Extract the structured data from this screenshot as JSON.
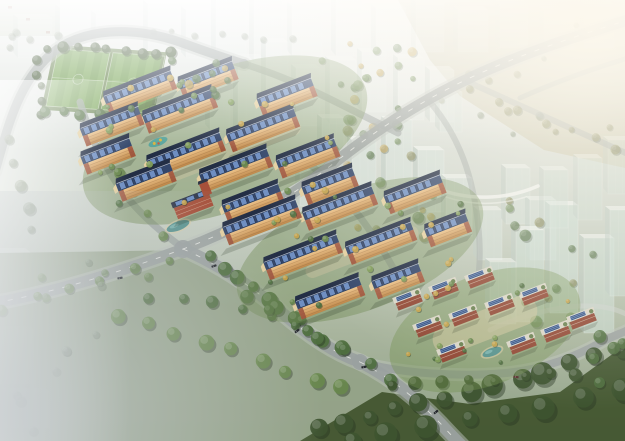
{
  "image": {
    "description": "aerial-render-residential-masterplan",
    "width": 625,
    "height": 441
  },
  "palette": {
    "road": "#9aa19f",
    "roadShoulder": "#bcc1bc",
    "roadLight": "#cdd2cd",
    "white": "#f2f4f1",
    "treeColors": [
      "#3e5430",
      "#507040",
      "#68884c",
      "#7f9c58",
      "#c4a24b",
      "#8a8a55",
      "#84937a"
    ],
    "treeShadow": "#263420",
    "glassTints": [
      "#e9efec",
      "#d4e1db",
      "#cadcd3"
    ],
    "glassSide": "#b9c8c1",
    "glassTop": "#f2f6f3",
    "panelBlue": "#6e8ec2",
    "panelEdge": "#1f2a40",
    "roofFront": "#33466b",
    "roofBack": "#232e45",
    "ridge": "#cfd8e6",
    "facadeTop": "#ecc289",
    "facadeBottom": "#bc8547",
    "brick": "#9a4f3b",
    "gableCream": "#e3cfa0",
    "townWall": "#914835",
    "townRoof": "#d9d5c6",
    "clubhouseWall": "#a6503a",
    "clubhouseRoof": "#333a4c",
    "water": "#4f8f8d",
    "sand": "#d8cba6",
    "fieldBase": "#6d9a4d",
    "fieldStripe": "#78a556",
    "fieldApron": "#5d7a42",
    "meadow": "#93a287",
    "darkTrees": "#42552f",
    "topRightMeadow": "#c8c5ac",
    "shadow": "#26321f",
    "car": "#23262b",
    "carRed": "#5a3330",
    "mist": "#c6cbd1",
    "redSpeck": "#8a4434"
  },
  "scene": {
    "whiteCity": [
      [
        18,
        18,
        34,
        40,
        0.22
      ],
      [
        60,
        8,
        28,
        46,
        0.25
      ],
      [
        96,
        14,
        40,
        44,
        0.22
      ],
      [
        148,
        4,
        30,
        52,
        0.28
      ],
      [
        186,
        10,
        26,
        48,
        0.3
      ],
      [
        216,
        0,
        30,
        54,
        0.3
      ],
      [
        254,
        0,
        28,
        62,
        0.32
      ],
      [
        292,
        6,
        30,
        50,
        0.3
      ],
      [
        336,
        0,
        26,
        56,
        0.3
      ],
      [
        376,
        8,
        30,
        48,
        0.28
      ],
      [
        416,
        2,
        28,
        50,
        0.26
      ],
      [
        458,
        10,
        30,
        42,
        0.24
      ],
      [
        500,
        4,
        28,
        44,
        0.22
      ],
      [
        544,
        10,
        30,
        40,
        0.2
      ],
      [
        584,
        4,
        30,
        44,
        0.18
      ]
    ],
    "topGhosts": [
      [
        238,
        58,
        26,
        78,
        0.4
      ],
      [
        266,
        42,
        22,
        66,
        0.42
      ],
      [
        296,
        68,
        24,
        58,
        0.4
      ],
      [
        330,
        60,
        26,
        64,
        0.38
      ],
      [
        362,
        52,
        24,
        60,
        0.35
      ],
      [
        398,
        58,
        26,
        62,
        0.38
      ],
      [
        430,
        70,
        24,
        52,
        0.4
      ],
      [
        210,
        80,
        20,
        50,
        0.35
      ]
    ],
    "midTowers": [
      [
        322,
        118,
        22,
        52,
        0.55
      ],
      [
        352,
        140,
        24,
        58,
        0.6
      ],
      [
        386,
        120,
        26,
        66,
        0.6
      ],
      [
        418,
        150,
        26,
        62,
        0.65
      ],
      [
        300,
        160,
        22,
        46,
        0.5
      ],
      [
        446,
        178,
        26,
        58,
        0.6
      ],
      [
        478,
        210,
        24,
        50,
        0.55
      ],
      [
        506,
        168,
        24,
        56,
        0.5
      ],
      [
        440,
        92,
        22,
        40,
        0.45
      ],
      [
        530,
        200,
        26,
        60,
        0.5
      ]
    ],
    "farTowers": [
      [
        516,
        230,
        28,
        92,
        0.62
      ],
      [
        550,
        205,
        28,
        108,
        0.65
      ],
      [
        584,
        238,
        30,
        95,
        0.6
      ],
      [
        610,
        210,
        26,
        86,
        0.55
      ],
      [
        544,
        170,
        24,
        58,
        0.4
      ],
      [
        578,
        158,
        24,
        62,
        0.4
      ],
      [
        608,
        140,
        22,
        54,
        0.35
      ],
      [
        490,
        262,
        26,
        62,
        0.55
      ]
    ],
    "leftGhosts": [
      [
        0,
        330,
        34,
        54,
        0.3
      ],
      [
        6,
        392,
        44,
        36,
        0.25
      ],
      [
        0,
        252,
        30,
        40,
        0.22
      ]
    ],
    "redSpecks": [
      [
        8,
        6
      ],
      [
        26,
        18
      ],
      [
        46,
        31
      ]
    ],
    "trMeadowPoly": "398,0 625,0 625,168 544,150 460,96 430,60",
    "meadowPoly": "0,253 190,250 252,286 332,342 424,402 392,441 0,441",
    "darkBandPoly": "300,441 382,392 470,404 560,392 625,345 625,441",
    "field": {
      "matrix": [
        1,
        0.067,
        -0.21,
        1,
        58,
        49
      ],
      "w": 104,
      "h": 57,
      "split": 52
    },
    "roads": [
      [
        "M -5,172 C 8,126 18,84 50,55 C 80,28 134,24 188,45 C 210,53 228,59 244,64",
        9,
        "road",
        0.85,
        "s"
      ],
      [
        "M 244,64 C 280,75 308,88 340,104 C 362,115 380,124 398,133",
        7,
        "road",
        0.7,
        ""
      ],
      [
        "M -6,303 C 56,292 120,272 183,249 C 246,226 292,196 334,163 C 376,130 424,99 474,76 C 522,54 570,38 628,20",
        11,
        "road",
        0.9,
        "sd"
      ],
      [
        "M 183,248 C 152,226 128,202 112,176 C 97,152 88,128 80,102",
        7,
        "road",
        0.75,
        ""
      ],
      [
        "M 183,249 C 218,264 250,285 280,311 C 306,334 332,352 360,362",
        12,
        "road",
        0.92,
        "sd"
      ],
      [
        "M 360,362 C 402,374 462,377 506,373 C 546,369 576,356 600,343 C 612,336 620,334 628,330",
        8,
        "road",
        0.9,
        "s"
      ],
      [
        "M 360,362 C 388,376 416,398 440,423 C 450,434 456,440 462,446",
        12,
        "road",
        0.92,
        "sd"
      ],
      [
        "M 306,161 C 330,181 352,205 368,228 C 384,251 398,274 407,297",
        7,
        "road",
        0.72,
        ""
      ],
      [
        "M 430,102 C 452,128 466,158 473,192 C 479,222 481,248 479,270",
        6,
        "road",
        0.5,
        ""
      ],
      [
        "M 468,82 L 628,154",
        6,
        "road",
        0.5,
        ""
      ],
      [
        "M 520,98 C 558,81 592,69 628,58",
        5,
        "road",
        0.45,
        ""
      ],
      [
        "M 490,330 C 520,316 550,308 580,306 C 600,305 614,308 626,314",
        5,
        "light",
        0.5,
        ""
      ],
      [
        "M 436,188 C 468,201 506,200 538,186",
        3.5,
        "white",
        0.8,
        ""
      ],
      [
        "M 446,197 C 472,206 500,205 526,197",
        1.6,
        "white",
        0.55,
        ""
      ]
    ],
    "junctions": [
      [
        183,
        249,
        9
      ],
      [
        360,
        362,
        8
      ],
      [
        244,
        64,
        5
      ]
    ],
    "lawns": [
      [
        225,
        140,
        150,
        70,
        "#6c884e",
        0.45
      ],
      [
        360,
        250,
        130,
        60,
        "#6c884e",
        0.4
      ],
      [
        485,
        330,
        100,
        55,
        "#74904f",
        0.4
      ]
    ],
    "plazas": [
      [
        235,
        150,
        140,
        16,
        "#cfc3a0",
        0.45
      ],
      [
        362,
        252,
        120,
        14,
        "#cfc3a0",
        0.4
      ],
      [
        485,
        325,
        110,
        30,
        "#d6c9a2",
        0.5
      ]
    ],
    "slabs": [
      [
        140,
        92,
        72
      ],
      [
        208,
        80,
        58
      ],
      [
        287,
        97,
        58
      ],
      [
        112,
        126,
        62
      ],
      [
        180,
        111,
        74
      ],
      [
        263,
        130,
        72
      ],
      [
        108,
        156,
        52
      ],
      [
        186,
        155,
        78
      ],
      [
        308,
        158,
        62
      ],
      [
        146,
        182,
        58
      ],
      [
        236,
        170,
        72
      ],
      [
        330,
        186,
        54
      ],
      [
        253,
        203,
        60
      ],
      [
        262,
        222,
        78
      ],
      [
        340,
        208,
        74
      ],
      [
        415,
        194,
        60
      ],
      [
        448,
        230,
        44
      ],
      [
        303,
        257,
        78
      ],
      [
        381,
        243,
        70
      ],
      [
        330,
        298,
        68
      ],
      [
        398,
        281,
        50
      ]
    ],
    "townhouses": [
      [
        408,
        299
      ],
      [
        444,
        288
      ],
      [
        480,
        277
      ],
      [
        428,
        326
      ],
      [
        464,
        315
      ],
      [
        500,
        304
      ],
      [
        534,
        294
      ],
      [
        452,
        351
      ],
      [
        522,
        343
      ],
      [
        556,
        331
      ],
      [
        582,
        318
      ]
    ],
    "clubhouse": [
      193,
      205
    ],
    "ponds": [
      [
        96,
        157,
        8,
        3
      ],
      [
        178,
        226,
        12,
        4.5
      ],
      [
        492,
        352,
        10,
        4
      ]
    ],
    "playground": [
      158,
      142
    ],
    "treeRows": [
      [
        46,
        47,
        170,
        54,
        9,
        5,
        0,
        0.95
      ],
      [
        34,
        60,
        42,
        112,
        5,
        4.5,
        0,
        0.9
      ],
      [
        44,
        112,
        156,
        119,
        7,
        4.5,
        1,
        0.95
      ],
      [
        168,
        62,
        156,
        110,
        4,
        4,
        1,
        0.85
      ],
      [
        208,
        258,
        338,
        348,
        10,
        7,
        1,
        0.95
      ],
      [
        122,
        314,
        342,
        388,
        9,
        6.5,
        2,
        0.9
      ],
      [
        152,
        296,
        300,
        318,
        6,
        5.5,
        1,
        0.85
      ],
      [
        318,
        430,
        622,
        352,
        13,
        9,
        0,
        0.95
      ],
      [
        350,
        441,
        625,
        392,
        8,
        10,
        0,
        0.9
      ],
      [
        248,
        296,
        392,
        378,
        7,
        6,
        1,
        0.9
      ],
      [
        392,
        388,
        576,
        372,
        8,
        5.5,
        0,
        0.9
      ],
      [
        12,
        142,
        30,
        232,
        5,
        5,
        6,
        0.6
      ],
      [
        472,
        92,
        618,
        150,
        7,
        4,
        5,
        0.55
      ],
      [
        152,
        30,
        290,
        40,
        7,
        3,
        6,
        0.45
      ],
      [
        92,
        130,
        160,
        235,
        6,
        4.5,
        2,
        0.8
      ],
      [
        2,
        308,
        170,
        262,
        6,
        5,
        2,
        0.75
      ]
    ],
    "treeRegions": [
      [
        298,
        42,
        135,
        68,
        16,
        2.5,
        5,
        [
          1,
          2,
          4
        ],
        0.8,
        11
      ],
      [
        320,
        118,
        185,
        125,
        22,
        3,
        6,
        [
          1,
          5,
          2,
          4
        ],
        0.6,
        12
      ],
      [
        505,
        200,
        118,
        135,
        14,
        3.5,
        6,
        [
          1,
          5,
          2
        ],
        0.6,
        13
      ],
      [
        432,
        24,
        190,
        118,
        12,
        2.5,
        4.5,
        [
          5,
          6
        ],
        0.5,
        14
      ],
      [
        95,
        75,
        245,
        135,
        28,
        2,
        3.5,
        [
          2,
          3,
          4,
          4,
          1
        ],
        0.95,
        15
      ],
      [
        252,
        188,
        215,
        122,
        26,
        2,
        3.5,
        [
          2,
          3,
          4,
          4,
          1
        ],
        0.95,
        16
      ],
      [
        392,
        272,
        185,
        108,
        18,
        2,
        3,
        [
          2,
          3,
          4,
          1
        ],
        0.95,
        17
      ],
      [
        2,
        8,
        70,
        52,
        6,
        3,
        4.5,
        [
          6
        ],
        0.4,
        18
      ],
      [
        35,
        240,
        115,
        115,
        8,
        3.5,
        5,
        [
          6,
          2
        ],
        0.55,
        19
      ],
      [
        582,
        325,
        42,
        60,
        5,
        5,
        7,
        [
          1
        ],
        0.85,
        20
      ],
      [
        182,
        52,
        70,
        48,
        8,
        3,
        4.5,
        [
          1,
          4
        ],
        0.8,
        21
      ],
      [
        0,
        350,
        90,
        90,
        5,
        4,
        6,
        [
          6
        ],
        0.35,
        22
      ]
    ],
    "cars": [
      [
        214,
        266,
        -18,
        0
      ],
      [
        297,
        331,
        -38,
        0
      ],
      [
        436,
        412,
        -40,
        0
      ],
      [
        516,
        377,
        6,
        1
      ],
      [
        120,
        278,
        -10,
        0
      ],
      [
        364,
        367,
        -10,
        0
      ]
    ]
  }
}
